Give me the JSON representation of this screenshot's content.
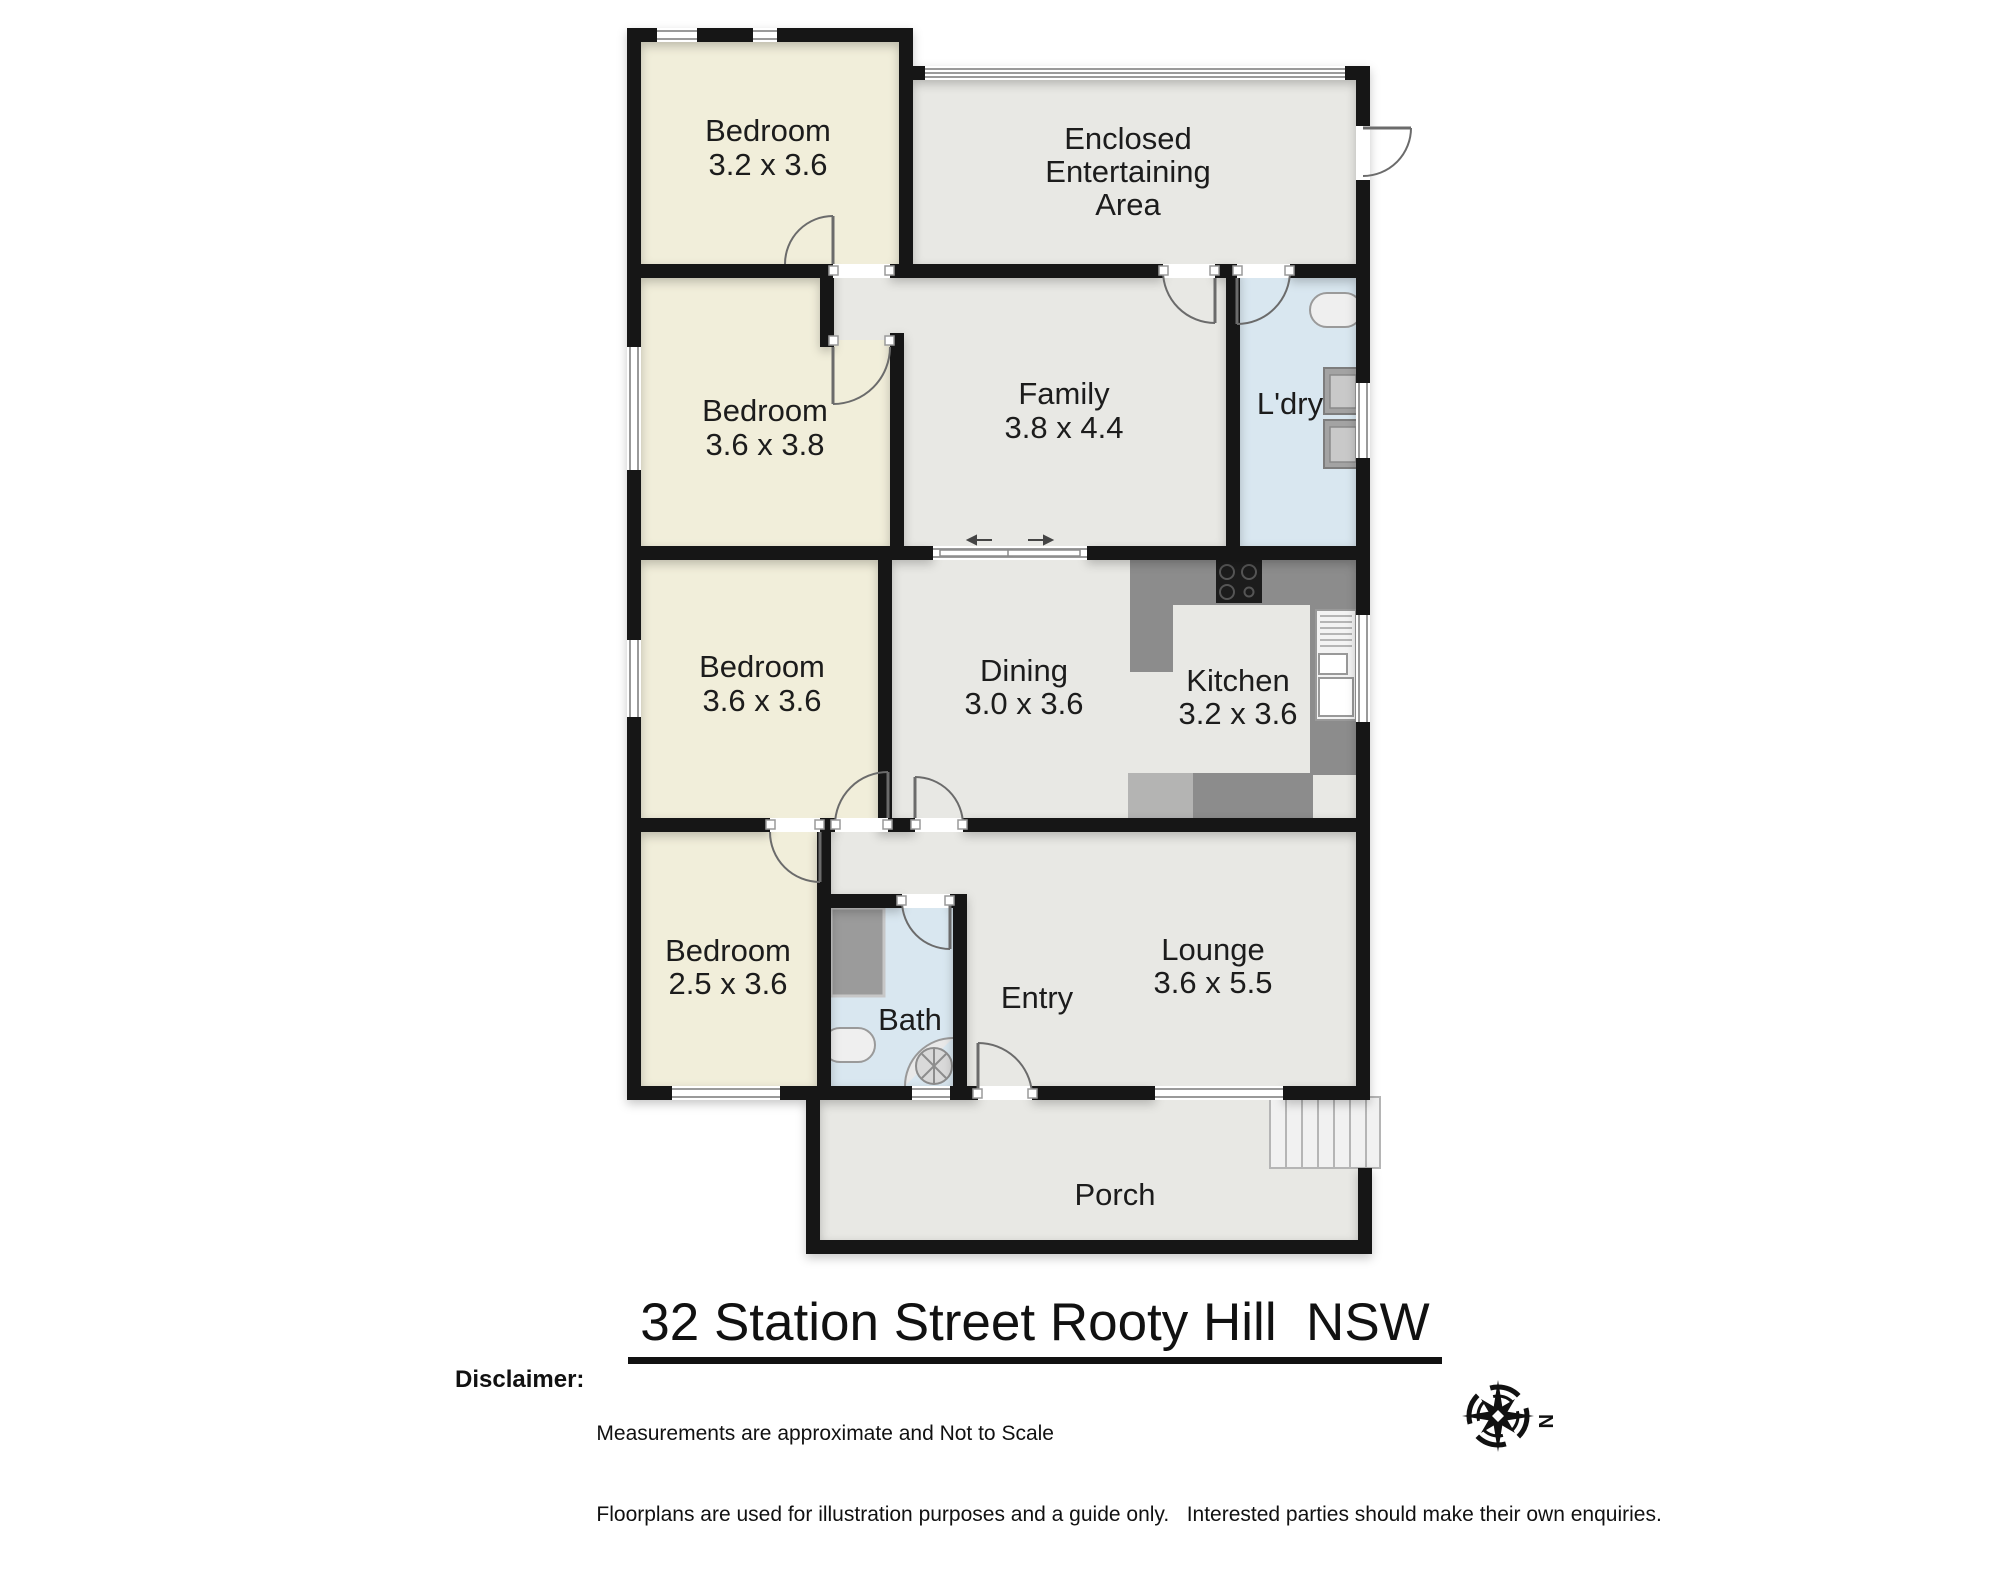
{
  "title": "32 Station Street Rooty Hill  NSW",
  "disclaimer": {
    "label": "Disclaimer:",
    "line1": "Measurements are approximate and Not to Scale",
    "line2": "Floorplans are used for illustration purposes and a guide only.   Interested parties should make their own enquiries."
  },
  "compass": {
    "north_label": "N"
  },
  "floorplan": {
    "rooms": {
      "bedroom1": {
        "name": "Bedroom",
        "dims": "3.2 x 3.6"
      },
      "entertaining": {
        "line1": "Enclosed",
        "line2": "Entertaining",
        "line3": "Area"
      },
      "bedroom2": {
        "name": "Bedroom",
        "dims": "3.6 x 3.8"
      },
      "family": {
        "name": "Family",
        "dims": "3.8 x 4.4"
      },
      "laundry": {
        "name": "L'dry"
      },
      "bedroom3": {
        "name": "Bedroom",
        "dims": "3.6 x 3.6"
      },
      "dining": {
        "name": "Dining",
        "dims": "3.0 x 3.6"
      },
      "kitchen": {
        "name": "Kitchen",
        "dims": "3.2 x 3.6"
      },
      "bedroom4": {
        "name": "Bedroom",
        "dims": "2.5 x 3.6"
      },
      "bath": {
        "name": "Bath"
      },
      "entry": {
        "name": "Entry"
      },
      "lounge": {
        "name": "Lounge",
        "dims": "3.6 x 5.5"
      },
      "porch": {
        "name": "Porch"
      }
    },
    "colors": {
      "bedroom_fill": "#f1eeda",
      "living_fill": "#e8e8e4",
      "wet_area_fill": "#d9e7f0",
      "wall": "#161616",
      "counter_dark": "#8c8c8c",
      "counter_light": "#b4b4b3"
    }
  }
}
